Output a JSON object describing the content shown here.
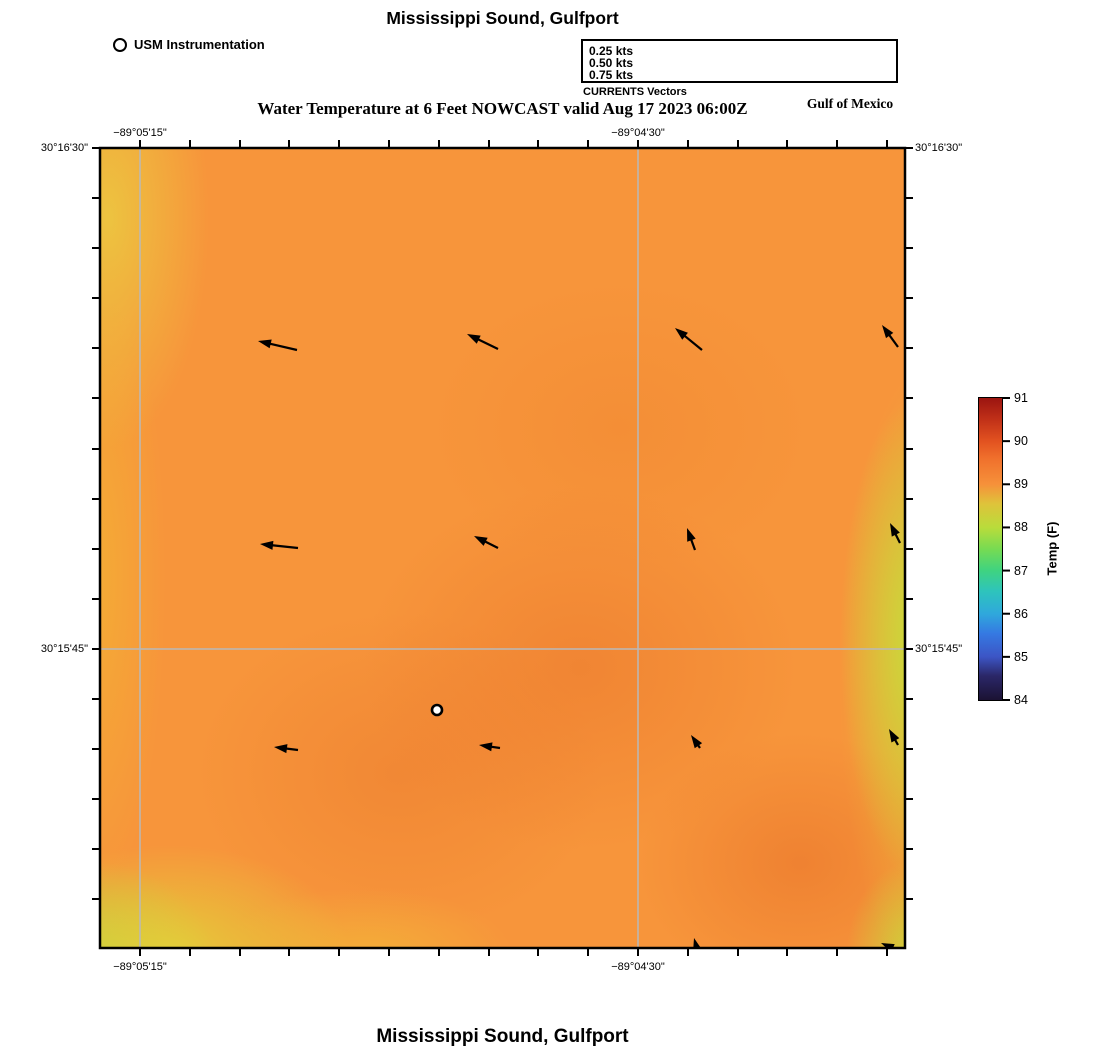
{
  "header": {
    "title": "Mississippi Sound, Gulfport",
    "instrument_legend": "USM Instrumentation",
    "currents_caption": "CURRENTS Vectors",
    "region_label": "Gulf of Mexico",
    "subtitle": "Water Temperature at 6 Feet NOWCAST valid Aug 17 2023 06:00Z"
  },
  "footer": {
    "title": "Mississippi Sound, Gulfport"
  },
  "currents_legend": {
    "box_px": {
      "left": 581,
      "top": 39,
      "width": 317,
      "height": 44
    },
    "arrow_x2": 308,
    "items": [
      {
        "label": "0.25 kts",
        "x1": 218,
        "y": 10
      },
      {
        "label": "0.50 kts",
        "x1": 148,
        "y": 22
      },
      {
        "label": "0.75 kts",
        "x1": 33,
        "y": 34
      }
    ]
  },
  "map_px": {
    "left": 100,
    "top": 148,
    "width": 805,
    "height": 800
  },
  "axes": {
    "x_labeled": [
      {
        "px": 140,
        "label": "−89°05'15\""
      },
      {
        "px": 638,
        "label": "−89°04'30\""
      }
    ],
    "y_labeled": [
      {
        "px": 148,
        "label": "30°16'30\""
      },
      {
        "px": 649,
        "label": "30°15'45\""
      }
    ],
    "x_ticks": [
      140,
      190,
      240,
      289,
      339,
      389,
      439,
      489,
      538,
      588,
      638,
      688,
      738,
      787,
      837,
      887
    ],
    "y_ticks": [
      148,
      198,
      248,
      298,
      348,
      398,
      449,
      499,
      549,
      599,
      649,
      699,
      749,
      799,
      849,
      899
    ],
    "grid_color": "#b9b9b9"
  },
  "colorbar": {
    "label": "Temp (F)",
    "ticks": [
      84,
      85,
      86,
      87,
      88,
      89,
      90,
      91
    ],
    "min": 84,
    "max": 91,
    "left": 979,
    "top": 398,
    "width": 23,
    "height": 302,
    "stops": [
      [
        0.0,
        "#1B1233"
      ],
      [
        0.08,
        "#2B2768"
      ],
      [
        0.143,
        "#3C55C5"
      ],
      [
        0.22,
        "#3579E2"
      ],
      [
        0.286,
        "#2FA8DC"
      ],
      [
        0.36,
        "#2EC4BC"
      ],
      [
        0.429,
        "#3FD380"
      ],
      [
        0.5,
        "#77DB52"
      ],
      [
        0.571,
        "#B9DC3B"
      ],
      [
        0.65,
        "#DFC33A"
      ],
      [
        0.714,
        "#F6913A"
      ],
      [
        0.8,
        "#F0702C"
      ],
      [
        0.857,
        "#E25220"
      ],
      [
        0.93,
        "#C03018"
      ],
      [
        1.0,
        "#9B1410"
      ]
    ]
  },
  "chart_data": {
    "type": "heatmap",
    "title": "Mississippi Sound, Gulfport",
    "subtitle": "Water Temperature at 6 Feet NOWCAST valid Aug 17 2023 06:00Z",
    "colorbar": {
      "label": "Temp (F)",
      "ticks": [
        84,
        85,
        86,
        87,
        88,
        89,
        90,
        91
      ],
      "range_F": [
        84,
        91
      ]
    },
    "x_tick_labels": [
      "−89°05'15\"",
      "−89°04'30\""
    ],
    "y_tick_labels": [
      "30°16'30\"",
      "30°15'45\""
    ],
    "field_estimate_F": {
      "typical": 89,
      "east_edge": 88,
      "southwest_corner": 87.5,
      "northwest_edge": 88.5,
      "warm_patches_south_central": 89.5
    },
    "currents_legend_kts": [
      0.25,
      0.5,
      0.75
    ],
    "current_direction_summary": "flow toward W–NW over most of map; toward N along east edge",
    "station_marker": "USM Instrumentation",
    "station_px": [
      337,
      562
    ],
    "vectors_px": [
      [
        197,
        202,
        158,
        193
      ],
      [
        398,
        201,
        367,
        186
      ],
      [
        602,
        202,
        575,
        180
      ],
      [
        798,
        199,
        782,
        177
      ],
      [
        198,
        400,
        160,
        396
      ],
      [
        398,
        400,
        374,
        388
      ],
      [
        595,
        402,
        587,
        380
      ],
      [
        800,
        395,
        790,
        375
      ],
      [
        198,
        602,
        174,
        599
      ],
      [
        400,
        600,
        379,
        597
      ],
      [
        600,
        600,
        591,
        587
      ],
      [
        798,
        597,
        789,
        581
      ],
      [
        600,
        812,
        594,
        790
      ],
      [
        806,
        806,
        781,
        795
      ]
    ]
  }
}
